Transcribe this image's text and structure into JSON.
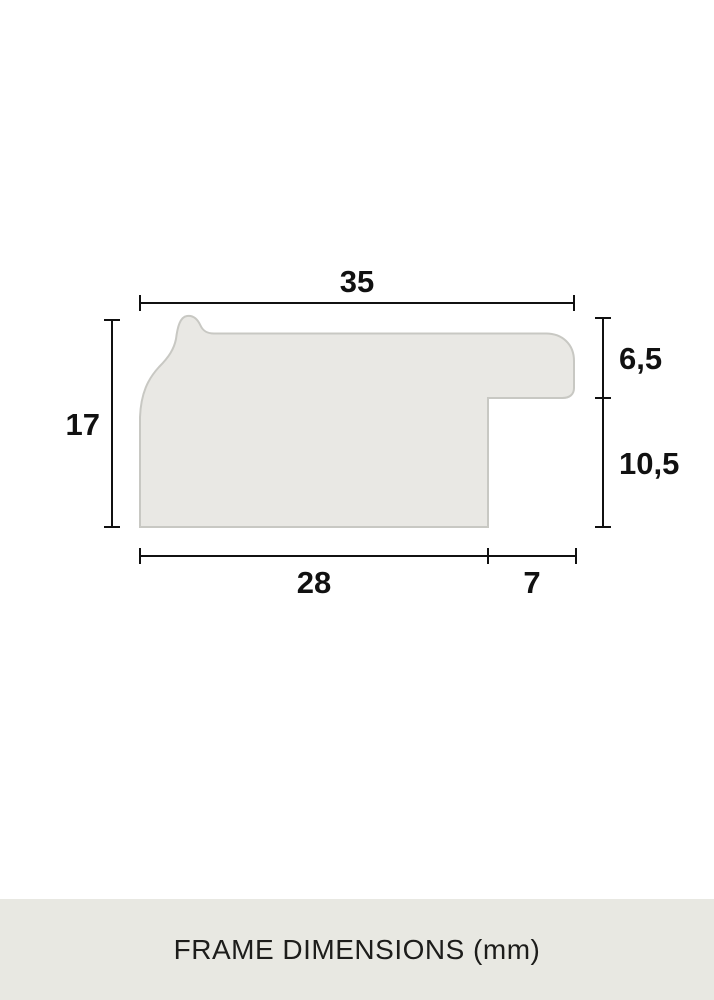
{
  "diagram": {
    "dimensions": {
      "total_width": "35",
      "total_height": "17",
      "lip_height": "6,5",
      "rabbet_height": "10,5",
      "base_width": "28",
      "rabbet_width": "7"
    },
    "colors": {
      "background": "#ffffff",
      "profile_fill": "#e9e8e4",
      "profile_stroke": "#c8c8c3",
      "dimension_color": "#111111",
      "caption_band": "#e8e8e2"
    }
  },
  "caption": {
    "label": "FRAME DIMENSIONS (mm)"
  }
}
